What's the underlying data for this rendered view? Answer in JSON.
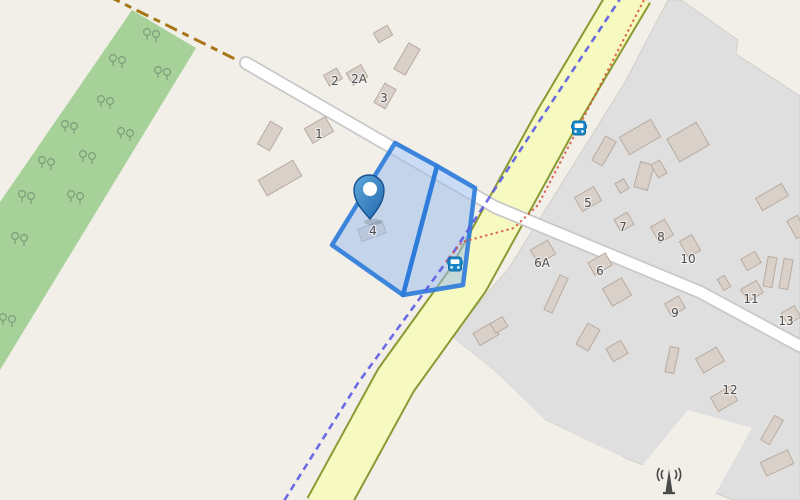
{
  "map": {
    "kind": "openstreetmap-style slippy map with highlighted parcel",
    "colors": {
      "land": "#f2efe9",
      "forest": "#a6d29a",
      "tree": "#7d9c7a",
      "residential": "#e0dfdf",
      "residential_edge": "#d2cfc8",
      "building_fill": "#d9d0c9",
      "building_stroke": "#b8aca0",
      "road_white_fill": "#ffffff",
      "road_white_casing": "#c8c8c8",
      "road_yellow_fill": "#f6f9c0",
      "road_yellow_casing": "#8a9a33",
      "track_brown": "#a87517",
      "boundary_blue": "#5c5ce6",
      "route_red": "#d9543b",
      "parcel_fill": "#9fc0ec",
      "parcel_stroke": "#2f7dda",
      "pin_light": "#5fa8dc",
      "pin_dark": "#2268ae",
      "pin_outline": "#16508f",
      "bus_blue": "#1987c7",
      "antenna_gray": "#4a4a4a",
      "label_color": "#4d4d4d"
    },
    "house_numbers": [
      {
        "t": "2",
        "x": 335,
        "y": 81
      },
      {
        "t": "2A",
        "x": 359,
        "y": 79
      },
      {
        "t": "3",
        "x": 384,
        "y": 98
      },
      {
        "t": "1",
        "x": 319,
        "y": 134
      },
      {
        "t": "4",
        "x": 373,
        "y": 231
      },
      {
        "t": "5",
        "x": 588,
        "y": 203
      },
      {
        "t": "7",
        "x": 623,
        "y": 227
      },
      {
        "t": "8",
        "x": 661,
        "y": 237
      },
      {
        "t": "10",
        "x": 688,
        "y": 259
      },
      {
        "t": "6A",
        "x": 542,
        "y": 263
      },
      {
        "t": "6",
        "x": 600,
        "y": 271
      },
      {
        "t": "11",
        "x": 751,
        "y": 299
      },
      {
        "t": "9",
        "x": 675,
        "y": 313
      },
      {
        "t": "13",
        "x": 786,
        "y": 321
      },
      {
        "t": "12",
        "x": 730,
        "y": 390
      }
    ],
    "landuse": {
      "forest_polygon": [
        [
          132,
          10
        ],
        [
          196,
          48
        ],
        [
          0,
          370
        ],
        [
          0,
          202
        ]
      ],
      "residential_polygon": [
        [
          668,
          0
        ],
        [
          681,
          0
        ],
        [
          738,
          40
        ],
        [
          736,
          54
        ],
        [
          800,
          96
        ],
        [
          800,
          500
        ],
        [
          733,
          500
        ],
        [
          620,
          456
        ],
        [
          543,
          419
        ],
        [
          496,
          372
        ],
        [
          451,
          336
        ],
        [
          509,
          268
        ],
        [
          624,
          84
        ]
      ],
      "cream_overlays": [
        [
          [
            451,
            336
          ],
          [
            496,
            372
          ],
          [
            545,
            420
          ],
          [
            625,
            458
          ],
          [
            598,
            500
          ],
          [
            451,
            500
          ]
        ],
        [
          [
            688,
            410
          ],
          [
            752,
            428
          ],
          [
            712,
            500
          ],
          [
            618,
            500
          ],
          [
            645,
            462
          ]
        ]
      ]
    },
    "roads": {
      "track": {
        "points": [
          [
            108,
            -4
          ],
          [
            237,
            60
          ]
        ],
        "width": 3,
        "dash": "13 6 7 6"
      },
      "residential_west": {
        "points": [
          [
            246,
            63
          ],
          [
            495,
            207
          ]
        ],
        "fill_width": 10.5,
        "casing_width": 14
      },
      "residential_east": {
        "points": [
          [
            495,
            207
          ],
          [
            700,
            292
          ],
          [
            800,
            346
          ]
        ],
        "fill_width": 10.5,
        "casing_width": 14
      },
      "secondary": {
        "points": [
          [
            632,
            -8
          ],
          [
            556,
            120
          ],
          [
            468,
            280
          ],
          [
            396,
            380
          ],
          [
            326,
            508
          ]
        ],
        "fill_width": 40,
        "casing_width": 44
      }
    },
    "lines": {
      "admin_boundary": {
        "points": [
          [
            622,
            -4
          ],
          [
            540,
            120
          ],
          [
            455,
            250
          ],
          [
            358,
            383
          ],
          [
            282,
            504
          ]
        ],
        "width": 2.6,
        "dash": "7 5"
      },
      "red_route": {
        "points": [
          [
            646,
            -4
          ],
          [
            572,
            140
          ],
          [
            538,
            205
          ],
          [
            514,
            228
          ],
          [
            462,
            242
          ],
          [
            445,
            263
          ]
        ],
        "width": 2.2,
        "dash": "0.5 5"
      }
    },
    "parcel": {
      "left_polygon": [
        [
          395,
          143
        ],
        [
          437,
          166
        ],
        [
          403,
          295
        ],
        [
          332,
          245
        ]
      ],
      "right_polygon": [
        [
          437,
          166
        ],
        [
          475,
          188
        ],
        [
          463,
          285
        ],
        [
          403,
          295
        ]
      ]
    },
    "buildings": [
      [
        383,
        34,
        16,
        11,
        -30
      ],
      [
        407,
        59,
        13,
        30,
        30
      ],
      [
        333,
        77,
        15,
        12,
        -30
      ],
      [
        357,
        75,
        17,
        14,
        -30
      ],
      [
        385,
        96,
        13,
        22,
        30
      ],
      [
        319,
        130,
        24,
        17,
        -30
      ],
      [
        270,
        136,
        14,
        26,
        30
      ],
      [
        280,
        178,
        40,
        18,
        -30
      ],
      [
        372,
        231,
        26,
        13,
        -20
      ],
      [
        640,
        137,
        36,
        20,
        -30
      ],
      [
        688,
        142,
        34,
        26,
        -30
      ],
      [
        604,
        151,
        12,
        28,
        30
      ],
      [
        644,
        176,
        14,
        26,
        15
      ],
      [
        659,
        169,
        10,
        15,
        -30
      ],
      [
        622,
        186,
        10,
        11,
        -30
      ],
      [
        588,
        199,
        22,
        16,
        -30
      ],
      [
        624,
        222,
        15,
        14,
        -30
      ],
      [
        662,
        231,
        16,
        18,
        -30
      ],
      [
        690,
        246,
        14,
        18,
        -30
      ],
      [
        772,
        197,
        30,
        14,
        -30
      ],
      [
        797,
        227,
        12,
        20,
        -30
      ],
      [
        543,
        252,
        20,
        16,
        -30
      ],
      [
        600,
        264,
        20,
        14,
        -30
      ],
      [
        556,
        294,
        9,
        38,
        25
      ],
      [
        617,
        292,
        22,
        20,
        -30
      ],
      [
        675,
        306,
        16,
        14,
        -30
      ],
      [
        588,
        337,
        14,
        24,
        30
      ],
      [
        617,
        351,
        17,
        15,
        -30
      ],
      [
        486,
        334,
        22,
        14,
        -30
      ],
      [
        499,
        325,
        14,
        11,
        -30
      ],
      [
        672,
        360,
        9,
        26,
        12
      ],
      [
        710,
        360,
        24,
        16,
        -30
      ],
      [
        724,
        399,
        22,
        16,
        -30
      ],
      [
        752,
        291,
        18,
        14,
        -30
      ],
      [
        751,
        261,
        16,
        13,
        -30
      ],
      [
        791,
        315,
        15,
        13,
        -30
      ],
      [
        770,
        272,
        9,
        30,
        10
      ],
      [
        786,
        274,
        9,
        30,
        10
      ],
      [
        724,
        283,
        8,
        13,
        -30
      ],
      [
        772,
        430,
        10,
        28,
        30
      ],
      [
        777,
        463,
        30,
        15,
        -25
      ]
    ],
    "trees": [
      [
        152,
        36
      ],
      [
        118,
        62
      ],
      [
        163,
        74
      ],
      [
        106,
        103
      ],
      [
        70,
        128
      ],
      [
        126,
        135
      ],
      [
        88,
        158
      ],
      [
        47,
        164
      ],
      [
        27,
        198
      ],
      [
        76,
        198
      ],
      [
        20,
        240
      ],
      [
        8,
        321
      ]
    ],
    "markers": {
      "pin": {
        "tip_x": 370,
        "tip_y": 219,
        "head_x": 369,
        "head_y": 190,
        "head_r": 15
      },
      "bus_stops": [
        [
          455,
          264
        ],
        [
          579,
          128
        ]
      ],
      "antenna": {
        "x": 669,
        "y": 483
      }
    }
  }
}
